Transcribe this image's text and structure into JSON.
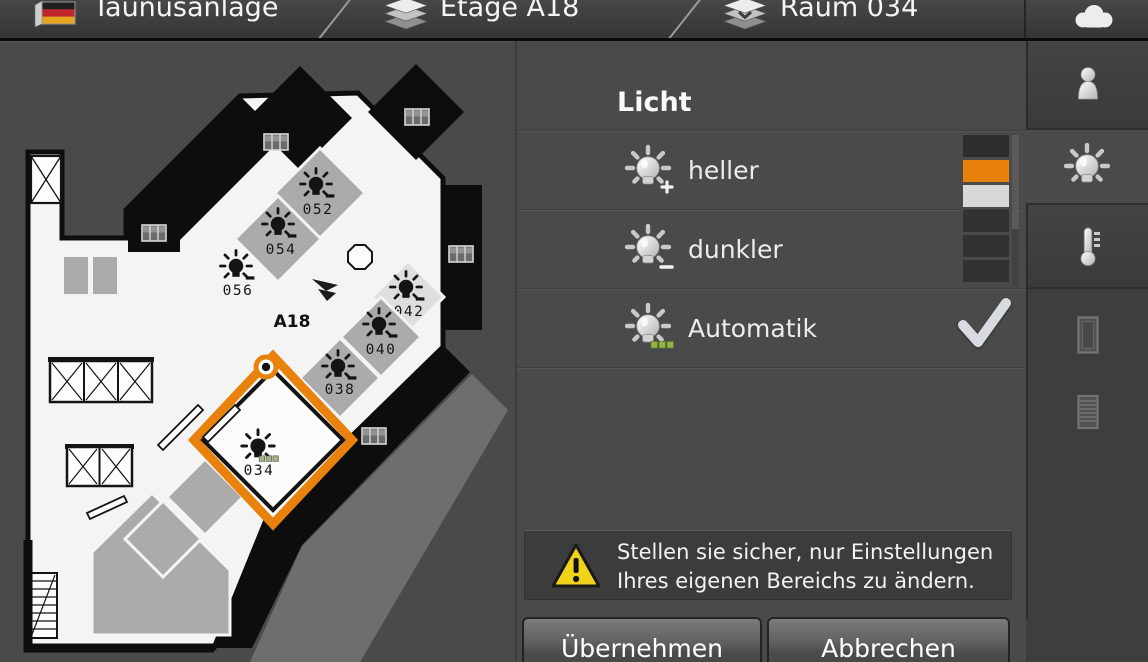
{
  "topbar": {
    "breadcrumbs": [
      {
        "label": "Taunusanlage",
        "icon": "german-flag-icon"
      },
      {
        "label": "Etage A18",
        "icon": "floor-layers-icon"
      },
      {
        "label": "Raum 034",
        "icon": "room-layers-icon"
      }
    ],
    "weather_icon": "cloud-icon"
  },
  "floorplan": {
    "floor_label": "A18",
    "selected_room": "034",
    "accent_color": "#e8820c",
    "rooms": [
      {
        "id": "052"
      },
      {
        "id": "054"
      },
      {
        "id": "056"
      },
      {
        "id": "042"
      },
      {
        "id": "040"
      },
      {
        "id": "038"
      },
      {
        "id": "034",
        "selected": true
      }
    ]
  },
  "panel": {
    "title": "Licht",
    "options": [
      {
        "label": "heller",
        "icon": "bulb-brighter-icon"
      },
      {
        "label": "dunkler",
        "icon": "bulb-darker-icon"
      },
      {
        "label": "Automatik",
        "icon": "bulb-auto-icon",
        "checked": true
      }
    ],
    "level_indicator": {
      "segments": [
        "#2d2d2d",
        "#e8820c",
        "#d8d8d8",
        "#323232",
        "#323232",
        "#323232"
      ],
      "active_color": "#e8820c"
    },
    "warning": {
      "line1": "Stellen sie sicher, nur Einstellungen",
      "line2": "Ihres eigenen Bereichs zu ändern."
    },
    "apply_label": "Übernehmen",
    "cancel_label": "Abbrechen"
  },
  "sidebar": {
    "tabs": [
      {
        "name": "presence",
        "icon": "person-icon"
      },
      {
        "name": "light",
        "icon": "bulb-icon",
        "selected": true
      },
      {
        "name": "temperature",
        "icon": "thermometer-icon"
      },
      {
        "name": "window",
        "icon": "window-icon",
        "disabled": true
      },
      {
        "name": "blinds",
        "icon": "blinds-icon",
        "disabled": true
      }
    ]
  }
}
